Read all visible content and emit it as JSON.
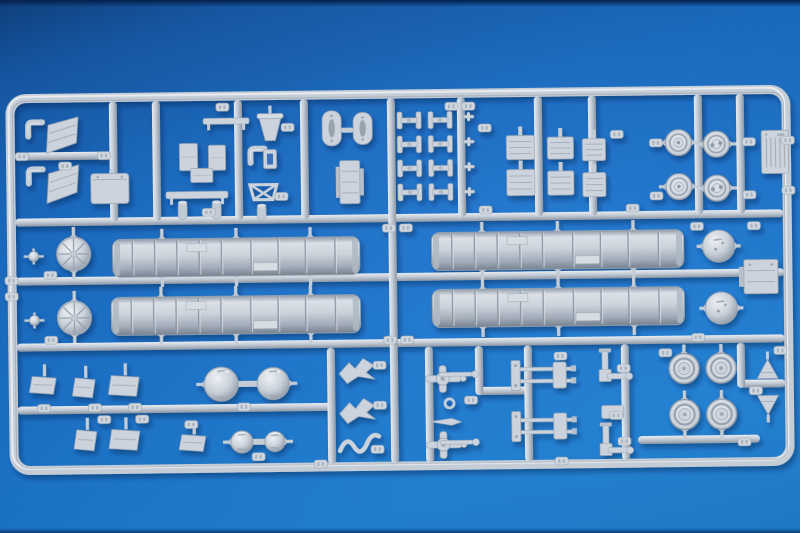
{
  "meta": {
    "subject": "Photograph of a light grey injection-moulded plastic model kit sprue (parts tree with missile canister halves, dome caps, road wheels and small fittings) lying on a blue background",
    "inventory": {
      "canister_halves": 4,
      "ribbed_dome_caps": 2,
      "smooth_dome_caps": 2,
      "dome_pairs": 2,
      "road_wheels": 4,
      "wheel_hubs": 4,
      "radiator_boxes": 6,
      "linkage_h_parts": 8,
      "part_number_tags": 52
    }
  },
  "palette": {
    "background_top": "#0a3e80",
    "background_mid": "#1571cd",
    "background_bottom": "#1c83da",
    "rail_light": "#e8ecf1",
    "rail_mid": "#c4ccd6",
    "rail_dark": "#8c97a5",
    "part_fill": "#ccd3dc",
    "part_edge": "#9aa5b2",
    "tag_fill": "#d0d7df",
    "tag_mark": "#a9b3bf",
    "shadow": "#021f44"
  },
  "frame": {
    "x": 12,
    "y": 94,
    "w": 776,
    "h": 372,
    "rx": 16,
    "thickness": 9
  },
  "h_rails": [
    [
      16,
      218,
      784
    ],
    [
      16,
      277,
      784
    ],
    [
      16,
      343,
      784
    ],
    [
      16,
      406,
      332
    ],
    [
      16,
      152,
      118
    ],
    [
      476,
      392,
      530
    ],
    [
      740,
      388,
      784
    ],
    [
      636,
      443,
      758
    ]
  ],
  "v_rails": [
    [
      115,
      98,
      218
    ],
    [
      158,
      98,
      218
    ],
    [
      240,
      98,
      218
    ],
    [
      306,
      98,
      218
    ],
    [
      463,
      98,
      218
    ],
    [
      540,
      98,
      218
    ],
    [
      594,
      98,
      218
    ],
    [
      700,
      98,
      218
    ],
    [
      742,
      98,
      218
    ],
    [
      393,
      98,
      463
    ],
    [
      330,
      347,
      463
    ],
    [
      428,
      347,
      463
    ],
    [
      478,
      347,
      396
    ],
    [
      527,
      347,
      463
    ],
    [
      624,
      347,
      463
    ],
    [
      740,
      347,
      392
    ]
  ],
  "cylinders": [
    {
      "x": 113,
      "y": 236,
      "w": 247,
      "h": 38
    },
    {
      "x": 432,
      "y": 233,
      "w": 252,
      "h": 38
    },
    {
      "x": 111,
      "y": 294,
      "w": 249,
      "h": 38
    },
    {
      "x": 432,
      "y": 290,
      "w": 252,
      "h": 38
    }
  ],
  "cyl_bands": [
    0.08,
    0.17,
    0.26,
    0.35,
    0.44,
    0.56,
    0.67,
    0.78,
    0.9
  ],
  "ribbed_domes": [
    [
      74,
      250,
      17
    ],
    [
      74,
      314,
      17
    ]
  ],
  "ball_pins": [
    [
      34,
      252
    ],
    [
      34,
      316
    ]
  ],
  "smooth_domes": [
    [
      719,
      250,
      16
    ],
    [
      721,
      312,
      16
    ]
  ],
  "dome_pairs": [
    {
      "c1": [
        220,
        382,
        17
      ],
      "c2": [
        272,
        382,
        16
      ]
    },
    {
      "c1": [
        240,
        440,
        11
      ],
      "c2": [
        273,
        440,
        10
      ]
    }
  ],
  "wheels": [
    [
      683,
      372
    ],
    [
      720,
      372
    ],
    [
      683,
      418
    ],
    [
      720,
      418
    ]
  ],
  "hubs": [
    {
      "c": [
        680,
        146
      ],
      "style": "ring"
    },
    {
      "c": [
        718,
        148
      ],
      "style": "spoke"
    },
    {
      "c": [
        680,
        190
      ],
      "style": "ring"
    },
    {
      "c": [
        718,
        192
      ],
      "style": "spoke"
    }
  ],
  "radiators": [
    [
      508,
      137,
      28,
      24
    ],
    [
      549,
      139,
      26,
      22
    ],
    [
      584,
      141,
      23,
      22
    ],
    [
      508,
      171,
      28,
      26
    ],
    [
      549,
      173,
      26,
      24
    ],
    [
      584,
      175,
      23,
      24
    ]
  ],
  "h_links": {
    "cols": [
      399,
      430
    ],
    "rows": [
      112,
      136,
      160,
      184
    ]
  },
  "pins": [
    [
      465,
      116
    ],
    [
      465,
      141
    ],
    [
      465,
      166
    ],
    [
      465,
      191
    ]
  ],
  "pill_plates": [
    [
      324,
      110,
      19,
      35
    ],
    [
      355,
      112,
      19,
      32
    ]
  ],
  "pill_link": [
    343,
    127
  ],
  "tall_box": [
    341,
    160,
    20,
    43
  ],
  "bucket": [
    261,
    112,
    22,
    27
  ],
  "thin_bars": [
    [
      205,
      116,
      46,
      6
    ],
    [
      167,
      189,
      62,
      7
    ]
  ],
  "cab_wedges": [
    [
      46,
      113,
      34,
      36
    ],
    [
      46,
      161,
      34,
      38
    ]
  ],
  "elbows": [
    [
      28,
      116
    ],
    [
      28,
      163
    ],
    [
      250,
      145
    ]
  ],
  "tank_box": [
    92,
    170,
    38,
    30
  ],
  "mid_boxes": [
    [
      181,
      141,
      18,
      27
    ],
    [
      210,
      143,
      17,
      25
    ],
    [
      192,
      166,
      22,
      14
    ]
  ],
  "hang_cyls": [
    [
      179,
      199,
      9,
      18
    ],
    [
      213,
      199,
      9,
      18
    ],
    [
      258,
      203,
      9,
      16
    ]
  ],
  "buckle": [
    265,
    148,
    13,
    19
  ],
  "cross_brace": [
    251,
    183,
    27,
    15
  ],
  "flag_boxes": [
    [
      31,
      372,
      24,
      18
    ],
    [
      74,
      374,
      20,
      20
    ],
    [
      110,
      372,
      28,
      21
    ],
    [
      75,
      426,
      20,
      21
    ],
    [
      110,
      426,
      28,
      21
    ],
    [
      180,
      432,
      24,
      17
    ]
  ],
  "birds": [
    [
      336,
      356
    ],
    [
      336,
      396
    ]
  ],
  "squiggle": [
    338,
    430
  ],
  "cross_fittings": [
    [
      424,
      366
    ],
    [
      424,
      432
    ]
  ],
  "rods": [
    [
      438,
      373
    ],
    [
      438,
      441
    ]
  ],
  "eyelet": [
    448,
    404
  ],
  "spear": [
    428,
    419
  ],
  "axles": [
    [
      510,
      362
    ],
    [
      510,
      413
    ]
  ],
  "elbow_asms": [
    [
      598,
      354
    ],
    [
      598,
      428
    ]
  ],
  "bracket": [
    600,
    408,
    22,
    13
  ],
  "cones": [
    {
      "p": [
        756,
        364
      ],
      "dir": "up"
    },
    {
      "p": [
        756,
        400
      ],
      "dir": "down"
    }
  ],
  "flange_box": [
    744,
    264,
    34,
    34
  ],
  "label_plate": [
    763,
    135,
    27,
    43
  ],
  "tags": [
    [
      218,
      101
    ],
    [
      447,
      103
    ],
    [
      464,
      103
    ],
    [
      17,
      148
    ],
    [
      99,
      148
    ],
    [
      60,
      158
    ],
    [
      283,
      122
    ],
    [
      276,
      191
    ],
    [
      203,
      206
    ],
    [
      480,
      125
    ],
    [
      480,
      207
    ],
    [
      612,
      133
    ],
    [
      627,
      207
    ],
    [
      651,
      142
    ],
    [
      744,
      142
    ],
    [
      651,
      195
    ],
    [
      744,
      195
    ],
    [
      783,
      141
    ],
    [
      783,
      191
    ],
    [
      5,
      272
    ],
    [
      5,
      288
    ],
    [
      383,
      224
    ],
    [
      400,
      224
    ],
    [
      383,
      336
    ],
    [
      400,
      336
    ],
    [
      44,
      267
    ],
    [
      44,
      332
    ],
    [
      691,
      226
    ],
    [
      691,
      337
    ],
    [
      748,
      226
    ],
    [
      36,
      400
    ],
    [
      87,
      400
    ],
    [
      127,
      400
    ],
    [
      236,
      401
    ],
    [
      96,
      412
    ],
    [
      134,
      412
    ],
    [
      183,
      418
    ],
    [
      250,
      451
    ],
    [
      372,
      361
    ],
    [
      372,
      401
    ],
    [
      369,
      445
    ],
    [
      463,
      397
    ],
    [
      553,
      354
    ],
    [
      553,
      459
    ],
    [
      616,
      367
    ],
    [
      608,
      414
    ],
    [
      616,
      440
    ],
    [
      312,
      459
    ],
    [
      736,
      442
    ],
    [
      748,
      391
    ],
    [
      773,
      351
    ],
    [
      658,
      352
    ]
  ]
}
